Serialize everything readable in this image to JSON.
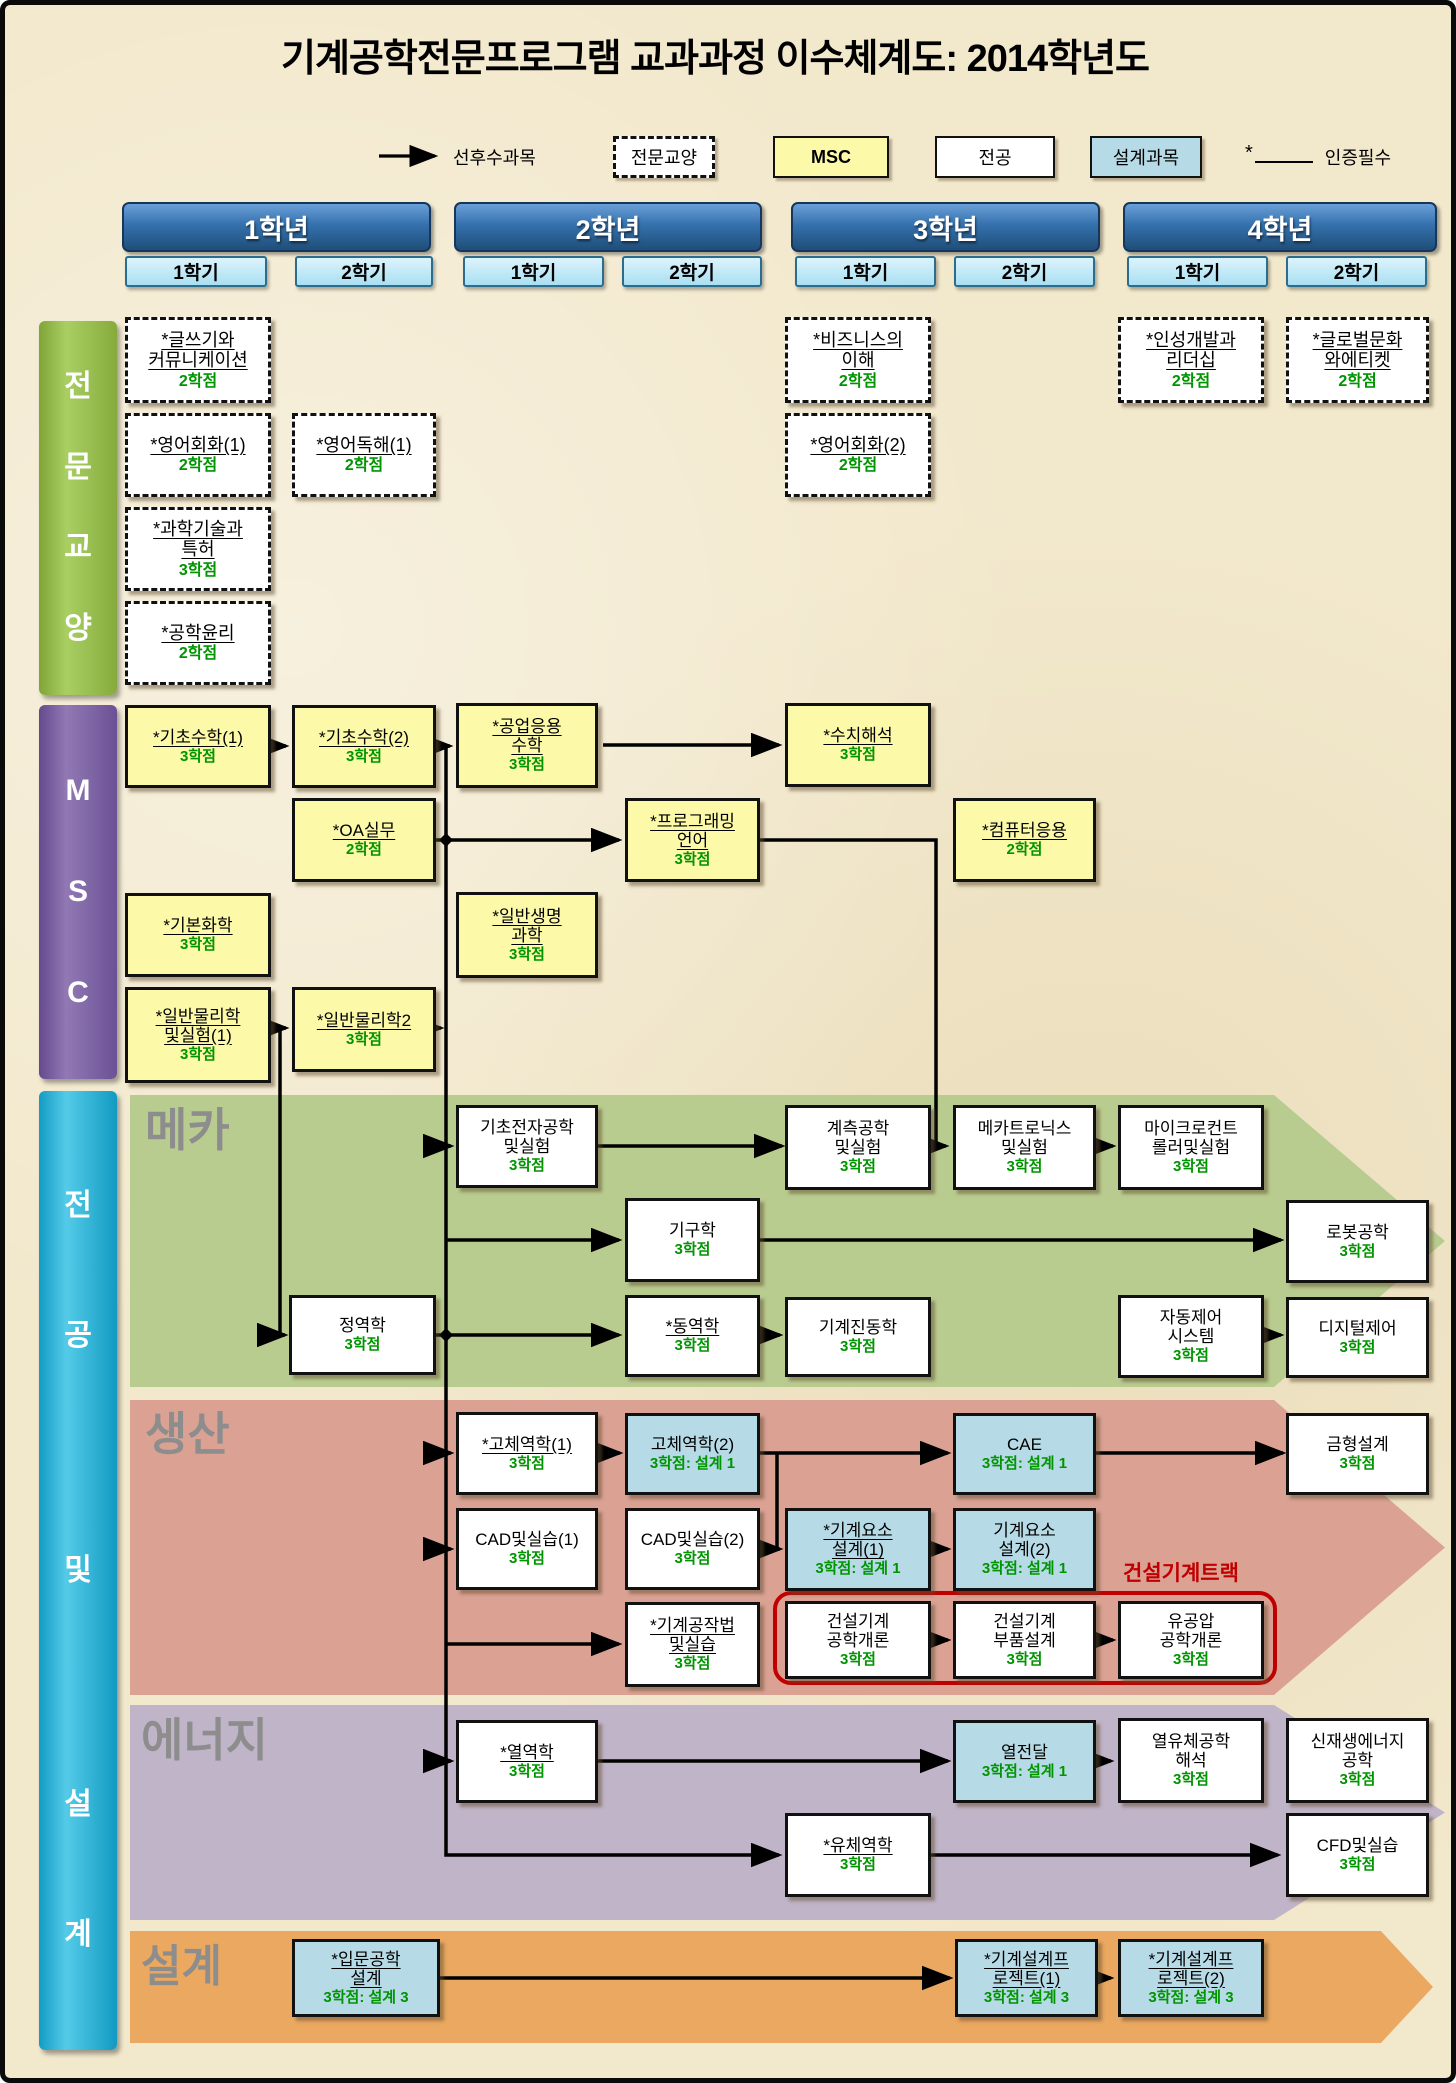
{
  "title": "기계공학전문프로그램 교과과정 이수체계도: 2014학년도",
  "legend": {
    "prerequisite": "선후수과목",
    "general": "전문교양",
    "msc": "MSC",
    "major": "전공",
    "design": "설계과목",
    "required_mark": "*",
    "required": "인증필수"
  },
  "years": [
    {
      "label": "1학년",
      "semesters": [
        "1학기",
        "2학기"
      ]
    },
    {
      "label": "2학년",
      "semesters": [
        "1학기",
        "2학기"
      ]
    },
    {
      "label": "3학년",
      "semesters": [
        "1학기",
        "2학기"
      ]
    },
    {
      "label": "4학년",
      "semesters": [
        "1학기",
        "2학기"
      ]
    }
  ],
  "categories": [
    {
      "id": "general",
      "label": "전문교양"
    },
    {
      "id": "msc",
      "label": "MSC"
    },
    {
      "id": "major",
      "label": "전공 및 설계"
    }
  ],
  "bands": [
    {
      "id": "meca",
      "label": "메카"
    },
    {
      "id": "prod",
      "label": "생산"
    },
    {
      "id": "energy",
      "label": "에너지"
    },
    {
      "id": "design",
      "label": "설계"
    }
  ],
  "track": {
    "label": "건설기계트랙",
    "courses": [
      "construction_intro",
      "construction_parts",
      "hydraulics"
    ]
  },
  "colors": {
    "background": "#f2e8cc",
    "year_header_blue": "#2e6da4",
    "semester_blue": "#aee0f5",
    "general_bar_green": "#8fb53f",
    "msc_bar_purple": "#7a5fa0",
    "major_bar_cyan": "#1fb0d8",
    "msc_box_yellow": "#fcf9a9",
    "design_box_blue": "#b6dbe7",
    "major_box_white": "#ffffff",
    "credit_green": "#009500",
    "band_meca": "#b9cc90",
    "band_prod": "#dba294",
    "band_energy": "#c0b4c8",
    "band_design": "#eaa861",
    "band_label_gray": "#8d8d8d",
    "track_red": "#c00000"
  },
  "courses": [
    {
      "id": "writing",
      "name": "*글쓰기와\n커뮤니케이션",
      "credit": "2학점",
      "type": "general",
      "grid": "1-1"
    },
    {
      "id": "english_conv1",
      "name": "*영어회화(1)",
      "credit": "2학점",
      "type": "general",
      "grid": "1-1"
    },
    {
      "id": "sci_patent",
      "name": "*과학기술과\n특허",
      "credit": "3학점",
      "type": "general",
      "grid": "1-1"
    },
    {
      "id": "ethics",
      "name": "*공학윤리",
      "credit": "2학점",
      "type": "general",
      "grid": "1-1"
    },
    {
      "id": "english_read1",
      "name": "*영어독해(1)",
      "credit": "2학점",
      "type": "general",
      "grid": "1-2"
    },
    {
      "id": "business",
      "name": "*비즈니스의\n이해",
      "credit": "2학점",
      "type": "general",
      "grid": "3-1"
    },
    {
      "id": "english_conv2",
      "name": "*영어회화(2)",
      "credit": "2학점",
      "type": "general",
      "grid": "3-1"
    },
    {
      "id": "leadership",
      "name": "*인성개발과\n리더십",
      "credit": "2학점",
      "type": "general",
      "grid": "4-1"
    },
    {
      "id": "global_culture",
      "name": "*글로벌문화\n와에티켓",
      "credit": "2학점",
      "type": "general",
      "grid": "4-2"
    },
    {
      "id": "math1",
      "name": "*기초수학(1)",
      "credit": "3학점",
      "type": "msc",
      "grid": "1-1"
    },
    {
      "id": "math2",
      "name": "*기초수학(2)",
      "credit": "3학점",
      "type": "msc",
      "grid": "1-2"
    },
    {
      "id": "eng_math",
      "name": "*공업응용\n수학",
      "credit": "3학점",
      "type": "msc",
      "grid": "2-1"
    },
    {
      "id": "numerical",
      "name": "*수치해석",
      "credit": "3학점",
      "type": "msc",
      "grid": "3-1"
    },
    {
      "id": "oa",
      "name": "*OA실무",
      "credit": "2학점",
      "type": "msc",
      "grid": "1-2"
    },
    {
      "id": "programming",
      "name": "*프로그래밍\n언어",
      "credit": "3학점",
      "type": "msc",
      "grid": "2-2"
    },
    {
      "id": "computer_app",
      "name": "*컴퓨터응용",
      "credit": "2학점",
      "type": "msc",
      "grid": "3-2"
    },
    {
      "id": "chemistry",
      "name": "*기본화학",
      "credit": "3학점",
      "type": "msc",
      "grid": "1-1"
    },
    {
      "id": "biology",
      "name": "*일반생명\n과학",
      "credit": "3학점",
      "type": "msc",
      "grid": "2-1"
    },
    {
      "id": "physics1",
      "name": "*일반물리학\n및실험(1)",
      "credit": "3학점",
      "type": "msc",
      "grid": "1-1"
    },
    {
      "id": "physics2",
      "name": "*일반물리학2",
      "credit": "3학점",
      "type": "msc",
      "grid": "1-2"
    },
    {
      "id": "electronics",
      "name": "기초전자공학\n및실험",
      "credit": "3학점",
      "type": "major",
      "band": "meca",
      "grid": "2-1"
    },
    {
      "id": "instrumentation",
      "name": "계측공학\n및실험",
      "credit": "3학점",
      "type": "major",
      "band": "meca",
      "grid": "3-1"
    },
    {
      "id": "mechatronics",
      "name": "메카트로닉스\n및실험",
      "credit": "3학점",
      "type": "major",
      "band": "meca",
      "grid": "3-2"
    },
    {
      "id": "microcontroller",
      "name": "마이크로컨트\n롤러및실험",
      "credit": "3학점",
      "type": "major",
      "band": "meca",
      "grid": "4-1"
    },
    {
      "id": "kinematics",
      "name": "기구학",
      "credit": "3학점",
      "type": "major",
      "band": "meca",
      "grid": "2-2"
    },
    {
      "id": "robotics",
      "name": "로봇공학",
      "credit": "3학점",
      "type": "major",
      "band": "meca",
      "grid": "4-2"
    },
    {
      "id": "statics",
      "name": "정역학",
      "credit": "3학점",
      "type": "major",
      "band": "meca",
      "grid": "1-2"
    },
    {
      "id": "dynamics",
      "name": "*동역학",
      "credit": "3학점",
      "type": "major",
      "band": "meca",
      "grid": "2-2"
    },
    {
      "id": "vibration",
      "name": "기계진동학",
      "credit": "3학점",
      "type": "major",
      "band": "meca",
      "grid": "3-1"
    },
    {
      "id": "auto_control",
      "name": "자동제어\n시스템",
      "credit": "3학점",
      "type": "major",
      "band": "meca",
      "grid": "4-1"
    },
    {
      "id": "digital_control",
      "name": "디지털제어",
      "credit": "3학점",
      "type": "major",
      "band": "meca",
      "grid": "4-2"
    },
    {
      "id": "solid1",
      "name": "*고체역학(1)",
      "credit": "3학점",
      "type": "major",
      "band": "prod",
      "grid": "2-1"
    },
    {
      "id": "solid2",
      "name": "고체역학(2)",
      "credit": "3학점: 설계 1",
      "type": "design",
      "band": "prod",
      "grid": "2-2"
    },
    {
      "id": "cae",
      "name": "CAE",
      "credit": "3학점: 설계 1",
      "type": "design",
      "band": "prod",
      "grid": "3-2"
    },
    {
      "id": "mold",
      "name": "금형설계",
      "credit": "3학점",
      "type": "major",
      "band": "prod",
      "grid": "4-2"
    },
    {
      "id": "cad1",
      "name": "CAD및실습(1)",
      "credit": "3학점",
      "type": "major",
      "band": "prod",
      "grid": "2-1"
    },
    {
      "id": "cad2",
      "name": "CAD및실습(2)",
      "credit": "3학점",
      "type": "major",
      "band": "prod",
      "grid": "2-2"
    },
    {
      "id": "machine_elements1",
      "name": "*기계요소\n설계(1)",
      "credit": "3학점: 설계 1",
      "type": "design",
      "band": "prod",
      "grid": "3-1"
    },
    {
      "id": "machine_elements2",
      "name": "기계요소\n설계(2)",
      "credit": "3학점: 설계 1",
      "type": "design",
      "band": "prod",
      "grid": "3-2"
    },
    {
      "id": "machining",
      "name": "*기계공작법\n및실습",
      "credit": "3학점",
      "type": "major",
      "band": "prod",
      "grid": "2-2"
    },
    {
      "id": "construction_intro",
      "name": "건설기계\n공학개론",
      "credit": "3학점",
      "type": "major",
      "band": "prod",
      "grid": "3-1"
    },
    {
      "id": "construction_parts",
      "name": "건설기계\n부품설계",
      "credit": "3학점",
      "type": "major",
      "band": "prod",
      "grid": "3-2"
    },
    {
      "id": "hydraulics",
      "name": "유공압\n공학개론",
      "credit": "3학점",
      "type": "major",
      "band": "prod",
      "grid": "4-1"
    },
    {
      "id": "thermodynamics",
      "name": "*열역학",
      "credit": "3학점",
      "type": "major",
      "band": "energy",
      "grid": "2-1"
    },
    {
      "id": "heat_transfer",
      "name": "열전달",
      "credit": "3학점: 설계 1",
      "type": "design",
      "band": "energy",
      "grid": "3-2"
    },
    {
      "id": "thermal_fluid",
      "name": "열유체공학\n해석",
      "credit": "3학점",
      "type": "major",
      "band": "energy",
      "grid": "4-1"
    },
    {
      "id": "renewable",
      "name": "신재생에너지\n공학",
      "credit": "3학점",
      "type": "major",
      "band": "energy",
      "grid": "4-2"
    },
    {
      "id": "fluid",
      "name": "*유체역학",
      "credit": "3학점",
      "type": "major",
      "band": "energy",
      "grid": "3-1"
    },
    {
      "id": "cfd",
      "name": "CFD및실습",
      "credit": "3학점",
      "type": "major",
      "band": "energy",
      "grid": "4-2"
    },
    {
      "id": "intro_design",
      "name": "*입문공학\n설계",
      "credit": "3학점: 설계 3",
      "type": "design",
      "band": "design",
      "grid": "1-2"
    },
    {
      "id": "project1",
      "name": "*기계설계프\n로젝트(1)",
      "credit": "3학점: 설계 3",
      "type": "design",
      "band": "design",
      "grid": "3-2"
    },
    {
      "id": "project2",
      "name": "*기계설계프\n로젝트(2)",
      "credit": "3학점: 설계 3",
      "type": "design",
      "band": "design",
      "grid": "4-1"
    }
  ],
  "prerequisites": [
    [
      "math1",
      "math2"
    ],
    [
      "math2",
      "eng_math"
    ],
    [
      "eng_math",
      "numerical"
    ],
    [
      "oa",
      "programming"
    ],
    [
      "physics1",
      "physics2"
    ],
    [
      "physics2",
      "msc-trunk"
    ],
    [
      "msc-trunk",
      "electronics"
    ],
    [
      "msc-trunk",
      "kinematics"
    ],
    [
      "msc-trunk",
      "statics"
    ],
    [
      "msc-trunk",
      "solid1"
    ],
    [
      "msc-trunk",
      "cad1"
    ],
    [
      "msc-trunk",
      "machining"
    ],
    [
      "msc-trunk",
      "thermodynamics"
    ],
    [
      "msc-trunk",
      "fluid"
    ],
    [
      "programming",
      "mechatronics"
    ],
    [
      "electronics",
      "instrumentation"
    ],
    [
      "instrumentation",
      "mechatronics"
    ],
    [
      "mechatronics",
      "microcontroller"
    ],
    [
      "kinematics",
      "robotics"
    ],
    [
      "statics",
      "dynamics"
    ],
    [
      "dynamics",
      "vibration"
    ],
    [
      "auto_control",
      "digital_control"
    ],
    [
      "solid1",
      "solid2"
    ],
    [
      "solid2",
      "cae"
    ],
    [
      "solid2",
      "machine_elements1"
    ],
    [
      "cad1",
      "cad2"
    ],
    [
      "cad2",
      "machine_elements1"
    ],
    [
      "cae",
      "mold"
    ],
    [
      "machine_elements1",
      "machine_elements2"
    ],
    [
      "construction_intro",
      "construction_parts"
    ],
    [
      "construction_parts",
      "hydraulics"
    ],
    [
      "thermodynamics",
      "heat_transfer"
    ],
    [
      "heat_transfer",
      "thermal_fluid"
    ],
    [
      "fluid",
      "cfd"
    ],
    [
      "intro_design",
      "project1"
    ],
    [
      "project1",
      "project2"
    ]
  ]
}
